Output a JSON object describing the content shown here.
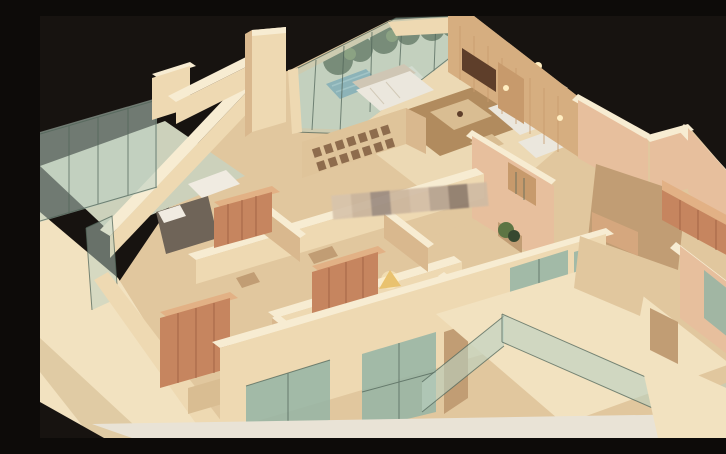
{
  "scene": {
    "type": "photograph",
    "subject": "architectural-scale-model",
    "description": "Top-down photograph of a wooden architectural scale model of an apartment: tan wood walls and floors, green glass balconies and windows, miniature furniture including white sofas, beds, red-brown wardrobes, a bookshelf and lamps, mounted on a cream wood base against a black background, with a blurred pixelated watermark strip across the middle."
  },
  "palette": {
    "bg": "#171310",
    "platform": "#f2e2c0",
    "platform_shade": "#e0cba4",
    "strip": "#e9e3d6",
    "floor": "#e1c79e",
    "floor_light": "#ecd9b4",
    "floor_dark": "#c19d74",
    "floor_glass": "#ccd1bb",
    "wall_top": "#f7ecd2",
    "wall_face": "#eed9b2",
    "wall_shade": "#d9b88e",
    "wall_pink": "#e7bf9d",
    "wall_pink_shade": "#d5a77e",
    "wood_panel": "#d6ae80",
    "wood_door": "#c79a6c",
    "wood_dark": "#5e3e2a",
    "wardrobe": "#c6855f",
    "wardrobe_dark": "#9e5f41",
    "wardrobe_top": "#e2b185",
    "glass": "#b9d0c2",
    "glass_dark": "#94b4a5",
    "glass_edge": "#51665a",
    "plant": "#374830",
    "plant_light": "#5d7544",
    "sofa": "#ebe7dd",
    "sofa_shade": "#cfc6b4",
    "sofa_blue": "#5f96af",
    "sofa_blue_light": "#8dbccd",
    "rug": "#b18b5e",
    "table": "#d9bd92",
    "bed": "#6f6458",
    "pillow": "#f0ebe1",
    "lamp": "#e9c26f",
    "glow": "#ffeec2",
    "shelf": "#dfc49a",
    "shelf_slot": "#7a573b"
  },
  "watermark": {
    "tiles": [
      "#d8c4ac",
      "#cab59d",
      "#9c8c81",
      "#ccb69d",
      "#d3bea7",
      "#b6a391",
      "#8e7b6d",
      "#d0bba3"
    ]
  }
}
